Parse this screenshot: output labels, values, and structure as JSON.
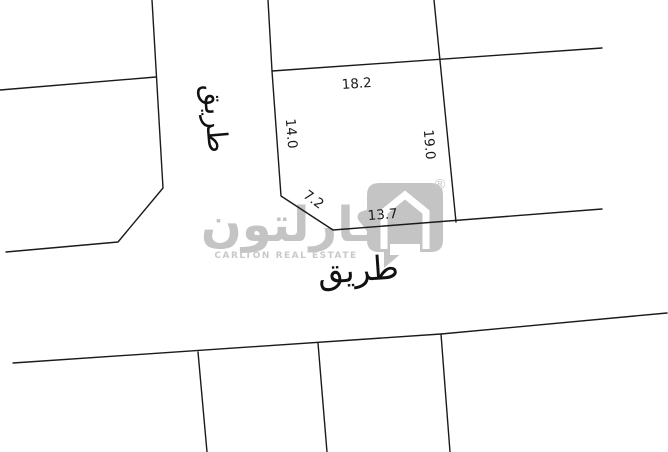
{
  "watermark": {
    "brand_arabic": "كارلتون",
    "brand_english": "CARLTON REAL ESTATE",
    "registered_mark": "®",
    "color_hex": "#c4c4c4"
  },
  "road_labels": {
    "vertical_road": "طريق",
    "horizontal_road": "طريق"
  },
  "dimensions": {
    "top": "18.2",
    "left": "14.0",
    "right": "19.0",
    "diagonal": "7.2",
    "bottom": "13.7"
  },
  "colors": {
    "line_hex": "#1a1a1a",
    "background_hex": "#ffffff"
  }
}
